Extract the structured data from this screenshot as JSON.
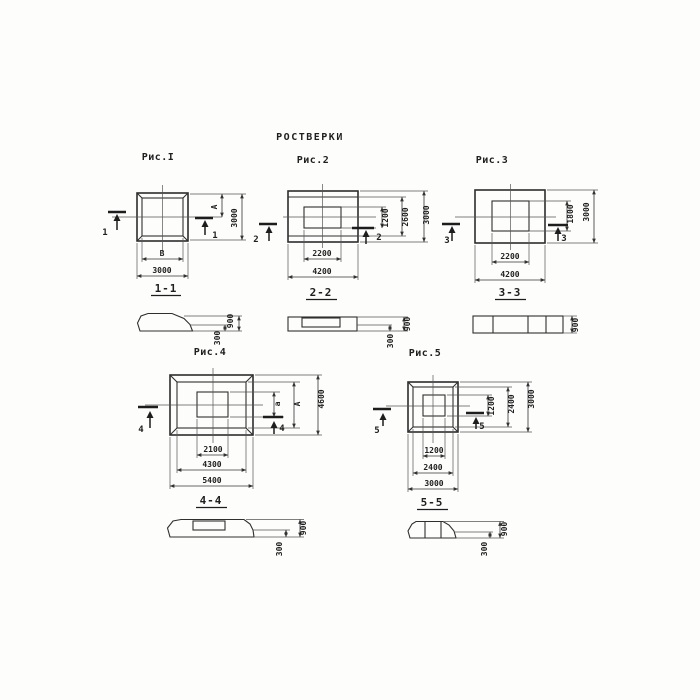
{
  "title": "РОСТВЕРКИ",
  "colors": {
    "ink": "#2d2d2d",
    "paper": "#fdfdfc"
  },
  "figures": [
    {
      "label": "Рис.I",
      "cut": "1",
      "section_title": "1-1",
      "dim_b_inner": "В",
      "dim_b_outer": "3000",
      "dim_r_inner": "А",
      "dim_r_outer": "3000"
    },
    {
      "label": "Рис.2",
      "cut": "2",
      "section_title": "2-2",
      "dim_b_inner": "2200",
      "dim_b_outer": "4200",
      "dim_r_inner": "1200",
      "dim_r_mid": "2600",
      "dim_r_outer": "3000"
    },
    {
      "label": "Рис.3",
      "cut": "3",
      "section_title": "3-3",
      "dim_b_inner": "2200",
      "dim_b_outer": "4200",
      "dim_r_inner": "1800",
      "dim_r_outer": "3000"
    },
    {
      "label": "Рис.4",
      "cut": "4",
      "section_title": "4-4",
      "dim_b_inner": "2100",
      "dim_b_mid": "4300",
      "dim_b_outer": "5400",
      "dim_r_inner": "а",
      "dim_r_mid": "А",
      "dim_r_outer": "4600"
    },
    {
      "label": "Рис.5",
      "cut": "5",
      "section_title": "5-5",
      "dim_b_inner": "1200",
      "dim_b_mid": "2400",
      "dim_b_outer": "3000",
      "dim_r_inner": "1200",
      "dim_r_mid": "2400",
      "dim_r_outer": "3000"
    }
  ],
  "sections": [
    {
      "height": "900",
      "edge": "300"
    },
    {
      "height": "900",
      "edge": "300"
    },
    {
      "height": "900"
    },
    {
      "height": "900",
      "edge": "300"
    },
    {
      "height": "900",
      "edge": "300"
    }
  ]
}
